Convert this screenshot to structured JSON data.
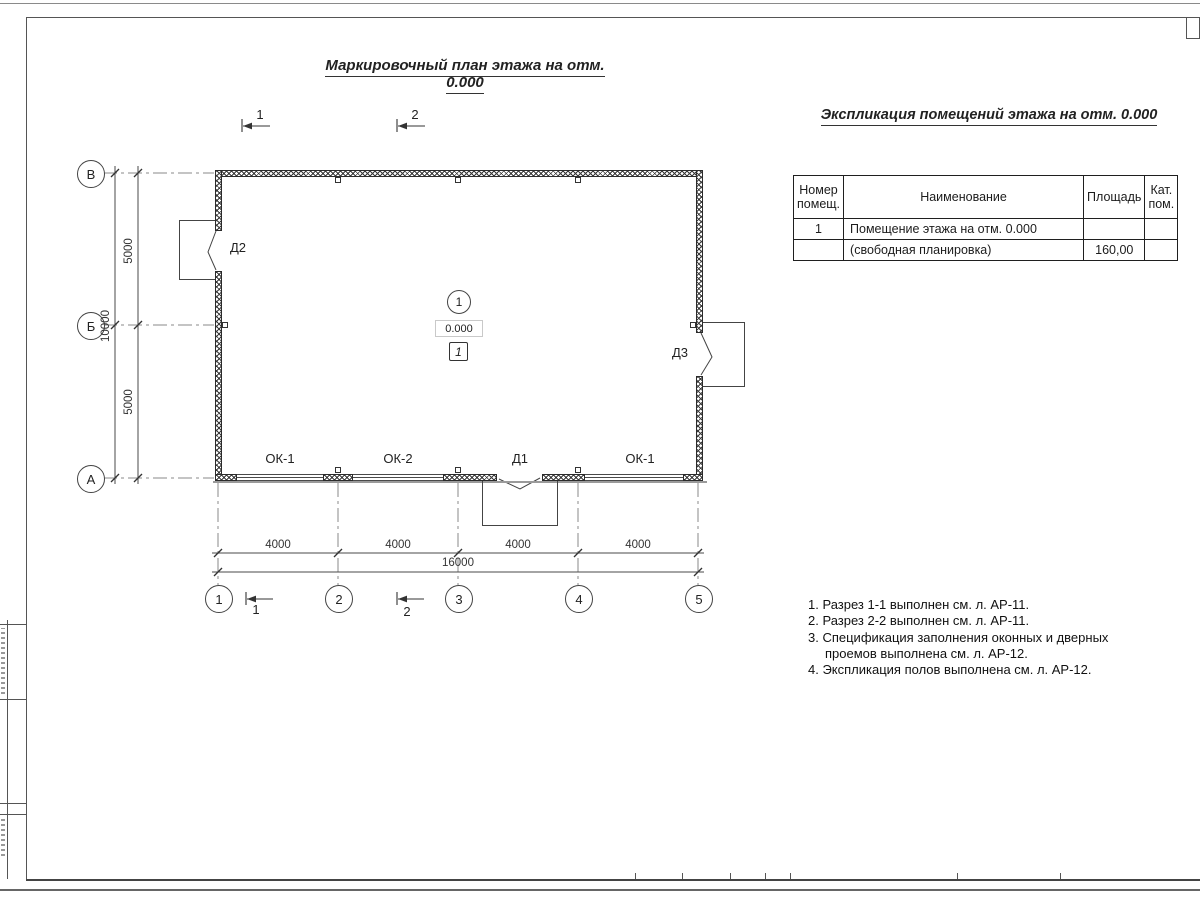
{
  "sheet": {
    "plan_title": "Маркировочный план этажа на отм. 0.000",
    "table_title": "Экспликация помещений этажа на отм. 0.000"
  },
  "plan": {
    "row_axes": [
      "В",
      "Б",
      "А"
    ],
    "col_axes": [
      "1",
      "2",
      "3",
      "4",
      "5"
    ],
    "v_dims": {
      "top": "5000",
      "bottom": "5000",
      "total": "10000"
    },
    "h_dims": {
      "segments": [
        "4000",
        "4000",
        "4000",
        "4000"
      ],
      "total": "16000"
    },
    "sections": {
      "s1": "1",
      "s2": "2"
    },
    "room": {
      "number": "1",
      "elevation": "0.000",
      "floor_type": "1"
    },
    "openings": {
      "d1": "Д1",
      "d2": "Д2",
      "d3": "Д3",
      "w1": "ОК-1",
      "w2": "ОК-2",
      "w3": "ОК-1"
    }
  },
  "table": {
    "headers": [
      "Номер помещ.",
      "Наименование",
      "Площадь",
      "Кат. пом."
    ],
    "rows": [
      {
        "num": "1",
        "name": "Помещение этажа на отм. 0.000",
        "area": "",
        "cat": ""
      },
      {
        "num": "",
        "name": "(свободная планировка)",
        "area": "160,00",
        "cat": ""
      }
    ]
  },
  "notes": [
    "1. Разрез 1-1 выполнен см. л. АР-11.",
    "2. Разрез 2-2 выполнен см. л. АР-11.",
    "3. Спецификация заполнения оконных и дверных проемов выполнена см. л. АР-12.",
    "4. Экспликация полов выполнена см. л. АР-12."
  ],
  "colors": {
    "line": "#3a3a3a",
    "axis": "#8a8a8a",
    "dim": "#4a4a4a"
  }
}
